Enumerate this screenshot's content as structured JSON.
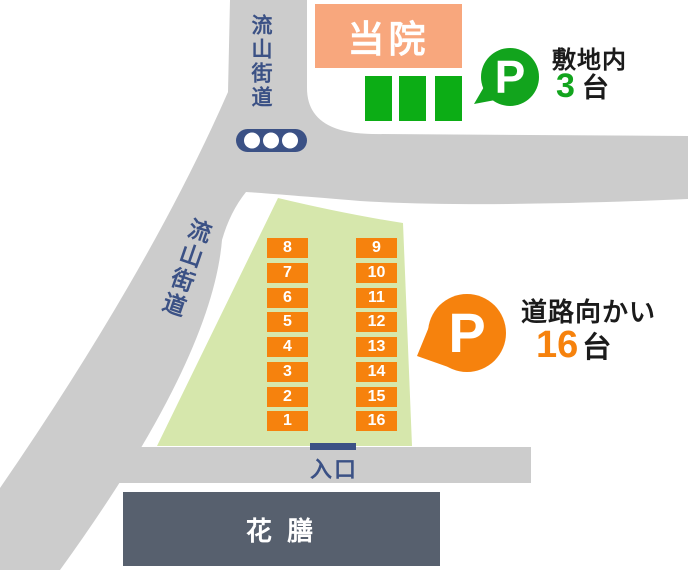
{
  "map": {
    "clinic_label": "当院",
    "road_top_label": "流山街道",
    "road_diagonal_label": "流山街道",
    "entrance_label": "入口",
    "restaurant_label": "花 膳"
  },
  "onsite_parking": {
    "badge_letter": "P",
    "area_label": "敷地内",
    "count": "3",
    "unit": "台",
    "space_count": 3
  },
  "offsite_parking": {
    "badge_letter": "P",
    "area_label": "道路向かい",
    "count": "16",
    "unit": "台",
    "left_column": [
      "8",
      "7",
      "6",
      "5",
      "4",
      "3",
      "2",
      "1"
    ],
    "right_column": [
      "9",
      "10",
      "11",
      "12",
      "13",
      "14",
      "15",
      "16"
    ]
  },
  "icons": {
    "traffic_light": "traffic-light",
    "parking_badge": "p-in-speech-bubble"
  },
  "colors": {
    "road": "#cccccc",
    "lot_green": "#d6e7ac",
    "spot_orange": "#f6820d",
    "parking_green": "#12a41d",
    "navy": "#3b5185",
    "clinic_peach": "#f8a77d",
    "restaurant_slate": "#57606e"
  }
}
